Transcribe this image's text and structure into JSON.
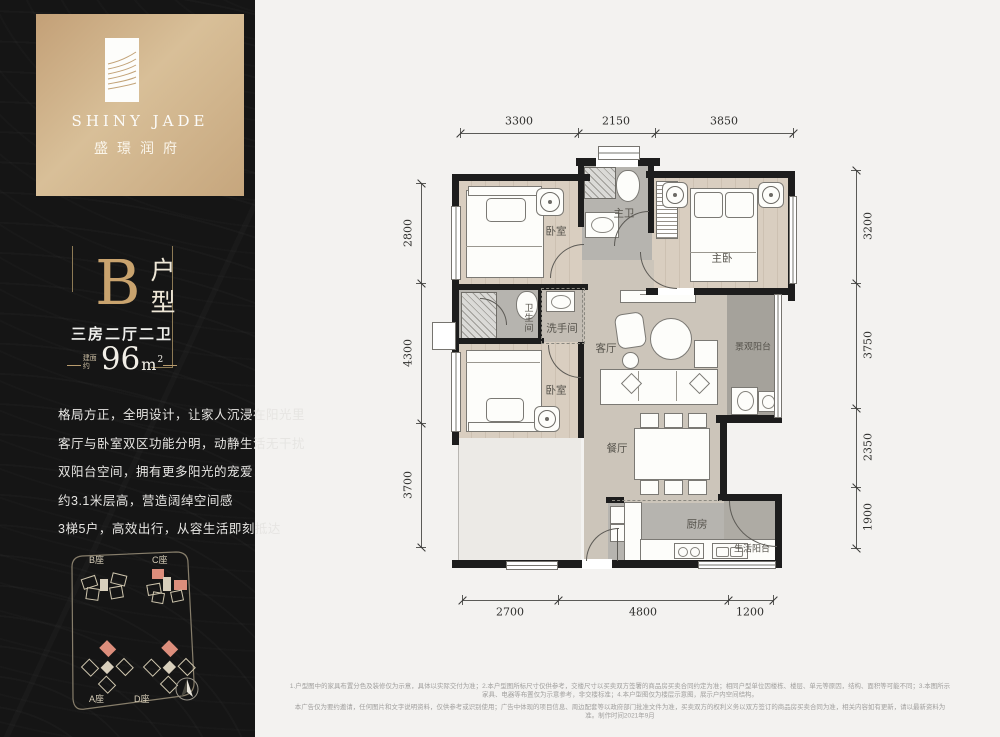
{
  "brand": {
    "logo_en": "SHINY JADE",
    "logo_cn": "盛璟润府"
  },
  "unit": {
    "type_letter": "B",
    "type_suffix": "户型",
    "layout": "三房二厅二卫",
    "area_prefix": "建面约",
    "area_number": "96",
    "area_unit": "m",
    "area_exponent": "2"
  },
  "description": {
    "lines": [
      "格局方正，全明设计，让家人沉浸在阳光里",
      "客厅与卧室双区功能分明，动静生活无干扰",
      "双阳台空间，拥有更多阳光的宠爱",
      "约3.1米层高，营造阔绰空间感",
      "3梯5户，高效出行，从容生活即刻抵达"
    ]
  },
  "site_plan": {
    "buildings": [
      {
        "label": "B座"
      },
      {
        "label": "C座"
      },
      {
        "label": "A座"
      },
      {
        "label": "D座"
      }
    ]
  },
  "floor_plan": {
    "rooms": {
      "bedroom_top": "卧室",
      "master_bath": "主卫",
      "master_bedroom": "主卧",
      "bath_second": "卫生间",
      "washroom": "洗手间",
      "living": "客厅",
      "view_balcony": "景观阳台",
      "bedroom_mid": "卧室",
      "dining": "餐厅",
      "kitchen": "厨房",
      "utility_balcony": "生活阳台"
    },
    "dimensions": {
      "top": [
        "3300",
        "2150",
        "3850"
      ],
      "left": [
        "2800",
        "4300",
        "3700"
      ],
      "right": [
        "3200",
        "3750",
        "2350",
        "1900"
      ],
      "bottom": [
        "2700",
        "4800",
        "1200"
      ]
    }
  },
  "footer": {
    "line1": "1.户型图中的家具布置分色及装修仅为示意，具体以实际交付为准；2.本户型图所标尺寸仅供参考，交楼尺寸以买卖双方签署的商品房买卖合同约定为准；相同户型单位因楼栋、楼层、单元等原因，结构、面积等可能不同；3.本图所示家具、电器等布置仅为示意参考，非交楼标准；4.本户型图仅为楼层示意图，展示户内空间结构。",
    "line2": "本广告仅为要约邀请，任何图片和文字说明资料，仅供参考或识别使用；广告中体现的项目信息、周边配套等以政府部门批准文件为准，买卖双方的权利义务以双方签订的商品房买卖合同为准，相关内容如有更新，请以最新资料为准。制作时间2021年9月"
  },
  "colors": {
    "gold_accent": "#c9a36e",
    "gold_panel": "#cbab82",
    "dark_panel": "#151515",
    "highlight_pink": "#dd8e7c",
    "wall": "#1d1d1d",
    "wood_floor": "#d9cec0",
    "tile_floor": "#b6b4af",
    "hall_floor": "#ccc5ba"
  }
}
